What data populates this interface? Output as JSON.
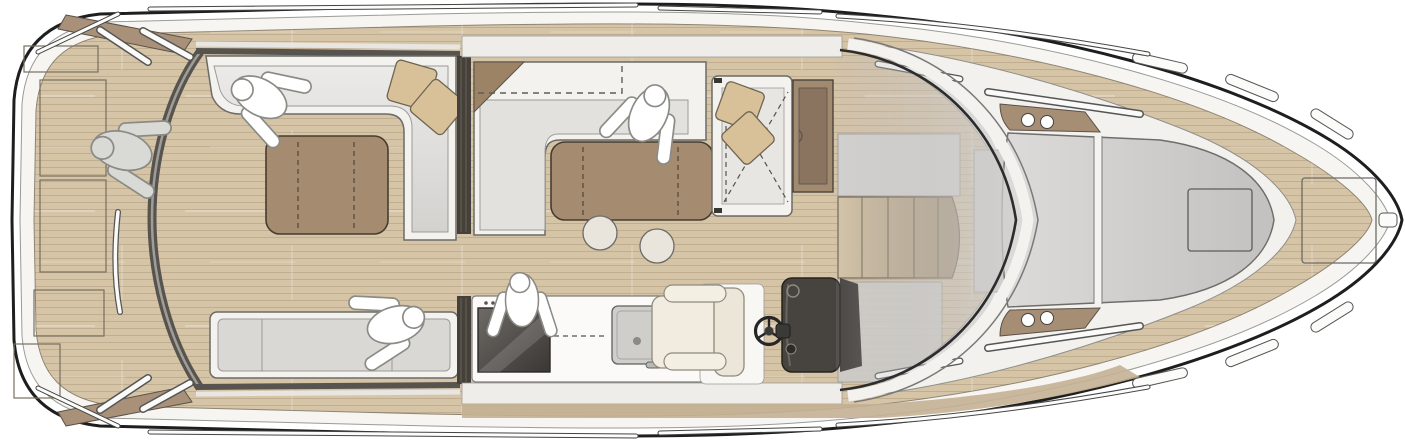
{
  "meta": {
    "type": "yacht-deck-plan",
    "view": "top-down",
    "orientation": "bow-right"
  },
  "areas": {
    "swim_platform": "swim-platform",
    "aft_cockpit": "aft-cockpit-lounge",
    "salon": "salon-dinette",
    "galley": "galley",
    "helm": "helm-station",
    "stairs": "companionway-stairs",
    "copilot": "co-pilot-seat",
    "sunpad": "foredeck-sunpad",
    "bow": "bow-deck"
  },
  "figures": {
    "count": 5,
    "poses": [
      "standing-swim-platform",
      "seated-cockpit-sofa",
      "seated-cockpit-bench",
      "standing-salon",
      "cooking-at-galley"
    ]
  },
  "fixtures": {
    "tables": 2,
    "stools": 2,
    "scatter_cushions": 4,
    "porthole_dots": 4,
    "deck_hatches": 2
  },
  "palette": {
    "background": "#ffffff",
    "hull_outline": "#1e1e1e",
    "hull_rim": "#f6f5f2",
    "deck_teak": "#d6c4a7",
    "deck_walkway_dark": "#c4b193",
    "cabin_white": "#f2f1ee",
    "sofa_white": "#f3f2ef",
    "sofa_seat": "#e3e1de",
    "bench_seat": "#d9d8d5",
    "table_brown": "#a58c70",
    "cushion_tan": "#d8c199",
    "stool_beige": "#eae5dc",
    "corner_wedge_brown": "#9c8366",
    "door_track_dark": "#454039",
    "transom_brown": "#a99179",
    "coaming_brown": "#a58e74",
    "cabinet_brown": "#a18a70",
    "cabinet_inner_brown": "#8a7460",
    "cooktop_dark": "#44403d",
    "counter_white": "#fbfaf8",
    "sink_gray": "#cfcecb",
    "helm_console_dark": "#47433f",
    "helm_seat_cream": "#f1ecdf",
    "windshield_frame_dark": "#2c2c2c",
    "sunpad_gray": "#d2d1cf",
    "gray_panel": "#d4d3d1",
    "stairs_wood_light": "#d6c5a6",
    "stairs_wood_dark": "#a08b6e",
    "figure_white": "#ffffff",
    "figure_gray": "#d9d9d6",
    "railing_white": "#fafaf8"
  }
}
